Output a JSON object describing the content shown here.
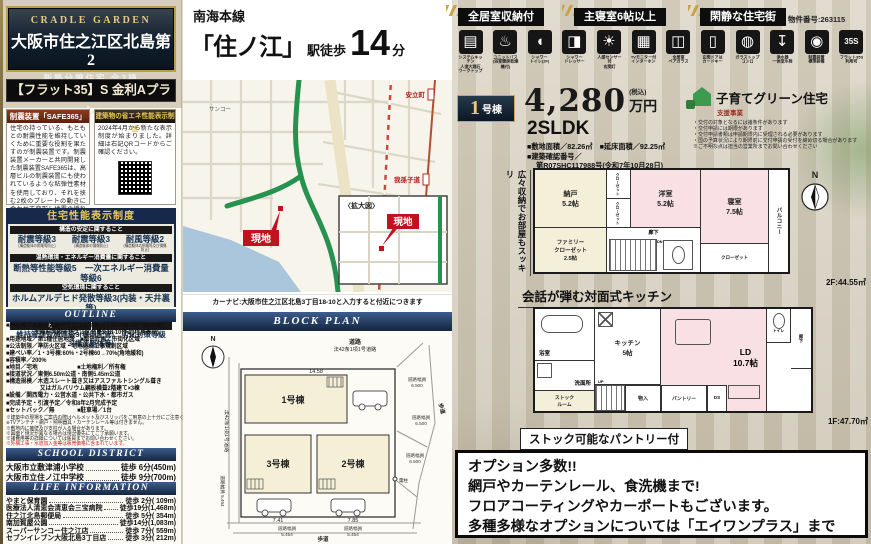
{
  "left": {
    "brand": "CRADLE GARDEN",
    "title": "大阪市住之江区北島第2",
    "subtitle": "新築分譲住宅 全3棟",
    "flat35_plan": "【フラット35】S 金利Aプラン",
    "damper": {
      "header": "制震装置「SAFE365」",
      "body": "住宅の持っている、もともとの耐震性能を維持していくために重要な役割を果たすのが制震装置です。制震装置メーカーと共同開発した制震装置SAFE365は、高層ビルの制震装置にも使われているような粘弾性素材を使用しており、それを挟む2枚のプレートの動きに合わせて変形し地震の揺れを吸収します。"
    },
    "energy": {
      "header": "建築物の省エネ性能表示制度",
      "body": "2024年4月から新たな表示制度が始まりました。詳細は右記QRコードからご確認ください。"
    },
    "performance": {
      "header": "住宅性能表示制度",
      "bar1": "構造の安定に関すること",
      "grades": [
        {
          "name": "耐震等級3",
          "sub": "(構造躯体の倒壊等防止)"
        },
        {
          "name": "耐震等級3",
          "sub": "(構造躯体の損傷防止)"
        },
        {
          "name": "耐風等級2",
          "sub": "(構造躯体の倒壊等及び損傷防止)"
        }
      ],
      "bar2": "温熱環境・エネルギー消費量に関すること",
      "row2": "断熱等性能等級5　一次エネルギー消費量等級6",
      "bar3": "空気環境に関すること",
      "row3": "ホルムアルデヒド発散等級3(内装・天井裏等)",
      "bar4a": "維持管理・更新への配慮に関すること",
      "bar4b": "劣化の軽減に関すること",
      "row4": "維持管理対策等級3(専用配管)　劣化対策等級3(構造躯体等)"
    },
    "outline": {
      "header": "OUTLINE",
      "lines": [
        "■所在地／大阪府大阪市住之江区北島三丁目14番7の一部(地番)",
        "　　　　　大阪府大阪市住之江区北島3-18-10付近(住居表示)",
        "■用途地域／第1種住居地域　■都市計画／市街化区域",
        "■公法制限／準防火区域・宅地造成工事規制区域",
        "■建ぺい率／1・3号棟:60%・2号棟60→70%(角地緩和)",
        "■容積率／200%",
        "■地目／宅地　　　　　　　■土地権利／所有権",
        "■接道状況／東側6.50m公道・南側5.45m公道",
        "■構造規模／木造スレート葺き又はアスファルトシングル葺き",
        "　　　　　　又はガルバリウム鋼板横葺2階建て×3棟",
        "■設備／関西電力・公営水道・公共下水・都市ガス",
        "■完成予定・引渡予定／令和8年2月完成予定",
        "■セットバック／無　　　　■駐車場／1台"
      ],
      "notes": [
        "※建築中の現場をご案内の際はヘルメット及びスリッパをご用意の上十分にご注意ください。",
        "※TVアンテナ・網戸・照明器具・カーテンレール等は付きません。",
        "※敷地内に擁壁及び支柱が入る場合があります。",
        "※図面と現況が異なる場合は現況優先にてご了承願います。",
        "※諸費用等の詳細については係員までお問い合わせください。",
        "※外構工事・水道加入金等は販売価格に含まれています。"
      ]
    },
    "school": {
      "header": "SCHOOL DISTRICT",
      "items": [
        {
          "name": "大阪市立敷津浦小学校",
          "value": "徒歩 6分(450m)"
        },
        {
          "name": "大阪市立住ノ江中学校",
          "value": "徒歩 9分(700m)"
        }
      ]
    },
    "life": {
      "header": "LIFE INFORMATION",
      "items": [
        {
          "name": "やまと保育園",
          "value": "徒歩 2分( 109m)"
        },
        {
          "name": "医療法人清恵会清恵会三宝病院",
          "value": "徒歩19分(1,468m)"
        },
        {
          "name": "住之江北島郵便局",
          "value": "徒歩 5分( 354m)"
        },
        {
          "name": "南加賀屋公園",
          "value": "徒歩14分(1,083m)"
        },
        {
          "name": "スーパーサンコー住之江店",
          "value": "徒歩 7分( 559m)"
        },
        {
          "name": "セブンイレブン大阪北島3丁目店",
          "value": "徒歩 3分( 212m)"
        }
      ]
    }
  },
  "middle": {
    "train": {
      "line": "南海本線",
      "station": "「住ノ江」",
      "walk": "駅徒歩",
      "minutes": "14",
      "unit": "分"
    },
    "map": {
      "site": "現地",
      "inset": "〈拡大図〉",
      "station1": "安立町",
      "station2": "我孫子道",
      "poi1": "サンコー",
      "caption": "カーナビ:大阪市住之江区北島3丁目18-10と入力すると付近につきます"
    },
    "block": {
      "header": "BLOCK PLAN",
      "north": "N",
      "road_top1": "道路",
      "road_top2": "法42条1項1号道路",
      "road_left": "法42条1項1号道路",
      "buildings": [
        "1号棟",
        "2号棟",
        "3号棟"
      ],
      "dims": {
        "top": "14.58",
        "b3": "7.41",
        "b2": "7.85"
      },
      "widths": [
        {
          "t": "道路幅員",
          "v": "6.500"
        },
        {
          "t": "道路幅員",
          "v": "6.500"
        },
        {
          "t": "道路幅員",
          "v": "6.500"
        },
        {
          "t": "道路幅員 5.454",
          "v": ""
        },
        {
          "t": "道路幅員",
          "v": "5.454"
        },
        {
          "t": "道路幅員",
          "v": "5.454"
        }
      ],
      "sidewalk": "歩道",
      "pole": "電柱"
    }
  },
  "right": {
    "badges": [
      "全居室収納付",
      "主寝室6帖以上",
      "閑静な住宅街"
    ],
    "property_no": "物件番号:263115",
    "features": [
      {
        "glyph": "▤",
        "label": "システムキッチン\n人造大理石\nワークトップ"
      },
      {
        "glyph": "♨",
        "label": "ユニットバス\n(浴室暖房乾燥機付)"
      },
      {
        "glyph": "◖",
        "label": "シャワー\nトイレ(2F)"
      },
      {
        "glyph": "◨",
        "label": "シャワー\nドレッサー"
      },
      {
        "glyph": "☀",
        "label": "人感センサー付\n玄関灯"
      },
      {
        "glyph": "▦",
        "label": "TVモニター付\nインターホン"
      },
      {
        "glyph": "◫",
        "label": "全居室\nペアガラス"
      },
      {
        "glyph": "▯",
        "label": "玄関ドアは\nカードキー"
      },
      {
        "glyph": "◍",
        "label": "ガラストップ\nコンロ"
      },
      {
        "glyph": "↧",
        "label": "浄水器\n一体型水栓"
      },
      {
        "glyph": "◉",
        "label": "制震装置\n標準装備"
      },
      {
        "glyph": "35S",
        "label": "フラット35S\n利用可"
      }
    ],
    "price": {
      "unit_no": "1",
      "unit_suffix": "号棟",
      "amount": "4,280",
      "currency": "万円",
      "tax": "(税込)",
      "layout": "2SLDK",
      "area_line": "■敷地面積／82.26㎡　■延床面積／92.25㎡",
      "confirm_label": "■建築確認番号／",
      "confirm_no": "第R07SHC117988号(令和7年10月28日)"
    },
    "kosodate": {
      "title": "子育てグリーン住宅",
      "subtitle": "支援事業",
      "notes": [
        "・交付の対象となるには諸条件があります",
        "・交付申請には期限があります",
        "・交付申請書類は申請期限内に受理される必要があります",
        "・国の予算状況により期限前に交付申請の受付を締め切る場合があります",
        "※ご不明な点は担当の営業所までお問い合わせください"
      ]
    },
    "plan2f": {
      "caption_left": "広々収納でお部屋もスッキリ",
      "rooms": {
        "nando": "納戸\n5.2帖",
        "closet1": "クローゼット",
        "closet2": "クローゼット",
        "yoshitsu": "洋室\n5.2帖",
        "shinshitsu": "寝室\n7.5帖",
        "closet3": "クローゼット",
        "family": "ファミリー\nクローゼット\n2.5帖",
        "hall": "廊下",
        "dn": "DN",
        "balcony": "バルコニー"
      },
      "area": "2F:44.55㎡"
    },
    "caption_mid": "会話が弾む対面式キッチン",
    "plan1f": {
      "rooms": {
        "bath": "浴室",
        "senmen": "洗面所",
        "stock": "ストック\nルーム",
        "kitchen": "キッチン\n5帖",
        "ld": "LD\n10.7帖",
        "toilet": "トイレ",
        "hall": "廊下",
        "up": "UP",
        "mono": "物入",
        "pantry": "パントリー",
        "ds": "DS"
      },
      "area": "1F:47.70㎡",
      "caption": "ストック可能なパントリー付"
    },
    "options": [
      "オプション多数!!",
      "網戸やカーテンレール、食洗機まで!",
      "フロアコーティングやカーポートもございます。",
      "多種多様なオプションについては「エイワンプラス」まで"
    ]
  }
}
